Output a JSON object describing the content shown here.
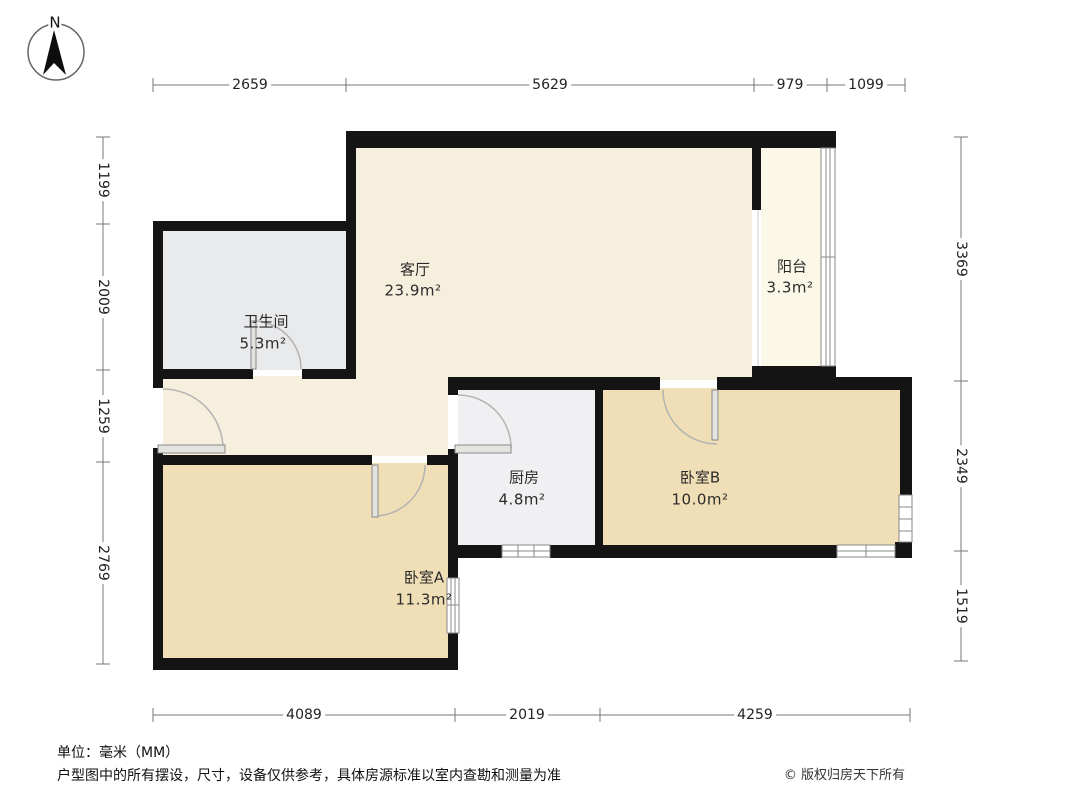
{
  "compass": {
    "label": "N"
  },
  "rooms": [
    {
      "id": "living",
      "name": "客厅",
      "area": "23.9m²"
    },
    {
      "id": "balcony",
      "name": "阳台",
      "area": "3.3m²"
    },
    {
      "id": "bathroom",
      "name": "卫生间",
      "area": "5.3m²"
    },
    {
      "id": "kitchen",
      "name": "厨房",
      "area": "4.8m²"
    },
    {
      "id": "bedroomB",
      "name": "卧室B",
      "area": "10.0m²"
    },
    {
      "id": "bedroomA",
      "name": "卧室A",
      "area": "11.3m²"
    }
  ],
  "dimensions": {
    "top": [
      "2659",
      "5629",
      "979",
      "1099"
    ],
    "left": [
      "1199",
      "2009",
      "1259",
      "2769"
    ],
    "right": [
      "3369",
      "2349",
      "1519"
    ],
    "bottom": [
      "4089",
      "2019",
      "4259"
    ]
  },
  "footer": {
    "unit_note": "单位：毫米（MM）",
    "disclaimer": "户型图中的所有摆设，尺寸，设备仅供参考，具体房源标准以室内查勘和测量为准",
    "copyright": "© 版权归房天下所有"
  },
  "colors": {
    "wall": "#141414",
    "living": "#F7EFDE",
    "balcony": "#FCF8E8",
    "bathroom": "#E9EAEC",
    "kitchen": "#F0F0F2",
    "bedroom": "#F0DFB6"
  }
}
